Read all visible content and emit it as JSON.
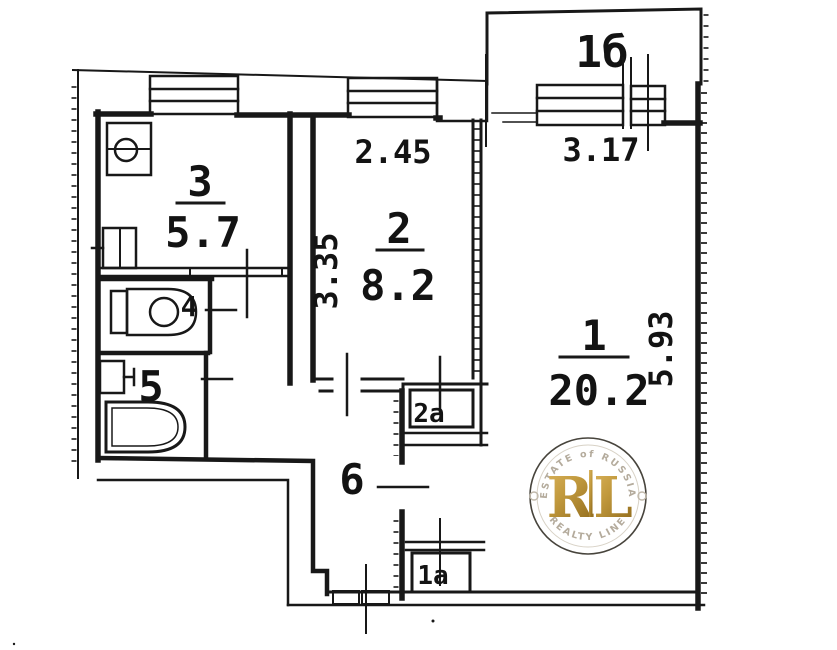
{
  "rooms": {
    "living": {
      "number": "1",
      "area": "20.2",
      "width": "3.17",
      "depth": "5.93"
    },
    "bedroom": {
      "number": "2",
      "area": "8.2",
      "width": "2.45",
      "depth": "3.35"
    },
    "kitchen": {
      "number": "3",
      "area": "5.7"
    },
    "wc": {
      "number": "4"
    },
    "bathroom": {
      "number": "5"
    },
    "hallway": {
      "number": "6"
    },
    "balcony": {
      "number": "1б"
    },
    "closet_upper": {
      "number": "2а"
    },
    "closet_lower": {
      "number": "1а"
    }
  },
  "watermark": {
    "arc_top": "ESTATE of RUSSIA",
    "arc_bottom": "REALTY LINE",
    "monogram_left": "R",
    "monogram_right": "L"
  },
  "icons": {
    "kitchen_sink": "sink-icon",
    "stove": "stove-icon",
    "toilet": "toilet-icon",
    "washbasin": "washbasin-icon",
    "bathtub": "bathtub-icon"
  },
  "colors": {
    "ink": "#181818",
    "paper": "#ffffff",
    "gold": "#c29a3e",
    "gold_dark": "#96701f",
    "ring": "#3a362e",
    "arc_text": "#b4ab9c"
  }
}
